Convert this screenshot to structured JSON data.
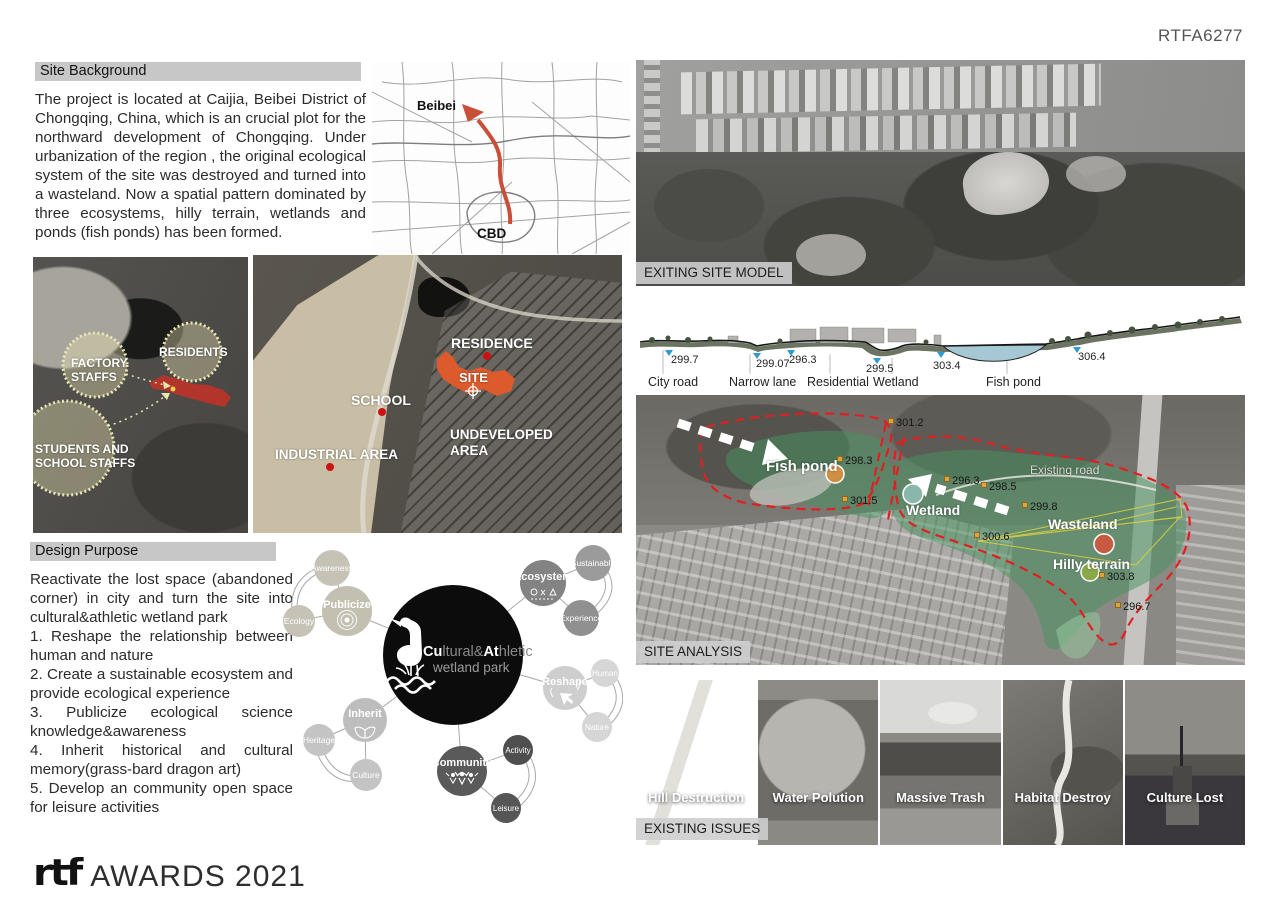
{
  "header": {
    "ref_code": "RTFA6277"
  },
  "colors": {
    "site_accent": "#dd5a2c",
    "boundary_red": "#e02222",
    "overlay_green": "#4c9b6e",
    "stakeholder_yellow": "#e9e6b4",
    "water_blue": "#2f9ad0",
    "route_orange": "#c85038",
    "titlebar_gray": "#c7c7c7"
  },
  "site_background": {
    "title": "Site Background",
    "body": "The project is located at Caijia, Beibei District of Chongqing, China, which is an crucial plot for the northward development of Chongqing. Under urbanization of the region , the original ecological system of the site was destroyed and turned into a wasteland. Now a spatial pattern dominated by three ecosystems, hilly terrain, wetlands and ponds (fish ponds) has been formed."
  },
  "location_map": {
    "beibei": "Beibei",
    "cbd": "CBD"
  },
  "site_model": {
    "caption": "EXITING SITE MODEL"
  },
  "stakeholder_map": {
    "factory_line1": "FACTORY",
    "factory_line2": "STAFFS",
    "residents": "RESIDENTS",
    "students_line1": "STUDENTS AND",
    "students_line2": "SCHOOL STAFFS"
  },
  "context_map": {
    "residence": "RESIDENCE",
    "site": "SITE",
    "school": "SCHOOL",
    "industrial": "INDUSTRIAL AREA",
    "undeveloped_line1": "UNDEVELOPED",
    "undeveloped_line2": "AREA"
  },
  "section_profile": {
    "elevations": [
      "299.7",
      "299.07",
      "296.3",
      "299.5",
      "303.4",
      "306.4"
    ],
    "labels": [
      "City road",
      "Narrow lane",
      "Residential",
      "Wetland",
      "Fish pond"
    ]
  },
  "site_analysis": {
    "caption": "SITE ANALYSIS",
    "fish_pond": "Fish pond",
    "wetland": "Wetland",
    "wasteland": "Wasteland",
    "hilly_terrain": "Hilly terrain",
    "existing_road": "Existing road",
    "elev_301_2": "301.2",
    "elev_298_3": "298.3",
    "elev_301_5": "301.5",
    "elev_296_3": "296.3",
    "elev_298_5": "298.5",
    "elev_299_8": "299.8",
    "elev_300_6": "300.6",
    "elev_303_8": "303.8",
    "elev_296_7": "296.7"
  },
  "design_purpose": {
    "title": "Design Purpose",
    "paragraphs": [
      "Reactivate the lost space (abandoned corner) in city and turn the site into cultural&athletic wetland park",
      "1. Reshape the relationship between human and nature",
      "2. Create a sustainable ecosystem and provide ecological experience",
      "3. Publicize ecological science knowledge&awareness",
      "4. Inherit historical and cultural memory(grass-bard dragon art)",
      "5. Develop an community open space for leisure activities"
    ]
  },
  "concept_diagram": {
    "center": {
      "seg1": "Cu",
      "seg2": "ltural&",
      "seg3": "At",
      "seg4": "hletic",
      "line2": "wetland park"
    },
    "nodes": {
      "publicize": "Publicize",
      "awareness": "Awareness",
      "ecology": "Ecology",
      "ecosystem": "Ecosystem",
      "sustainable": "Sustainable",
      "experience": "Experience",
      "reshape": "Reshape",
      "human": "Human",
      "nature": "Nature",
      "inherit": "Inherit",
      "heritage": "Heritage",
      "culture": "Culture",
      "community": "Community",
      "activity": "Activity",
      "leisure": "Leisure"
    }
  },
  "existing_issues": {
    "caption": "EXISTING ISSUES",
    "items": [
      "Hill Destruction",
      "Water Polution",
      "Massive Trash",
      "Habitat Destroy",
      "Culture Lost"
    ]
  },
  "footer": {
    "logo": "rtf",
    "award": "AWARDS 2021"
  }
}
